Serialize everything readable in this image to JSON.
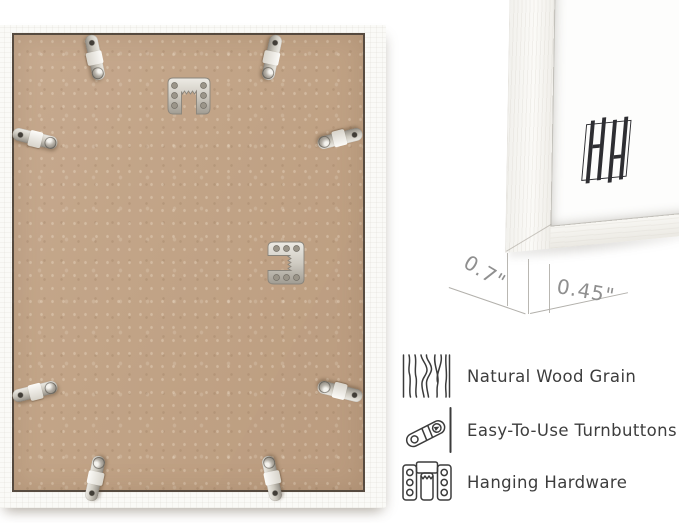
{
  "frame_back": {
    "backing_color": "#c2a385",
    "frame_color": "#fafaf7",
    "metal_color": "#cdc9bf",
    "hardware": {
      "turnbuttons": 8,
      "sawtooth_hangers": 2
    }
  },
  "corner_detail": {
    "logo_icon": "brand-frame-logo",
    "logo_color": "#2e2e32",
    "dimensions": [
      {
        "id": "depth",
        "label": "0.7\""
      },
      {
        "id": "face_width",
        "label": "0.45\""
      }
    ],
    "annotation_color": "#8f8f8f"
  },
  "features": [
    {
      "icon": "wood-grain-icon",
      "label": "Natural Wood Grain"
    },
    {
      "icon": "turnbutton-icon",
      "label": "Easy-To-Use Turnbuttons"
    },
    {
      "icon": "hanging-hardware-icon",
      "label": "Hanging Hardware"
    }
  ],
  "text_color": "#3d3d3d"
}
